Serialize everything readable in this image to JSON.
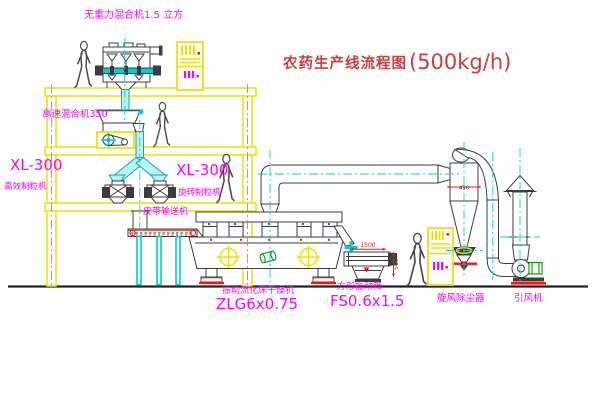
{
  "title": {
    "text": "农药生产线流程图",
    "capacity": "(500kg/h)"
  },
  "labels": {
    "gravity_mixer": "无重力混合机1.5 立方",
    "high_speed_mixer": "高速混合机350",
    "granulator_left_model": "XL-300",
    "granulator_left_name": "高效制粒机",
    "granulator_right_model": "XL-300",
    "granulator_right_name": "旋转制粒机",
    "belt_conveyor": "皮带输送机",
    "dryer_name": "振动流化床干燥机",
    "dryer_model": "ZLG6x0.75",
    "screen_name": "方形振动筛",
    "screen_model": "FS0.6x1.5",
    "cyclone": "旋风除尘器",
    "fan": "引风机"
  },
  "dimensions": {
    "screen_length": "1500",
    "screen_height": "500",
    "cyclone_diameter": "450"
  },
  "colors": {
    "structure_yellow": "#f0e000",
    "label_magenta": "#ff00ff",
    "title_red": "#cf3a3a",
    "centerline_cyan": "#00d5d5",
    "accent_red": "#ff1111",
    "machine_green": "#009900",
    "line_dark": "#3c3c3c"
  }
}
